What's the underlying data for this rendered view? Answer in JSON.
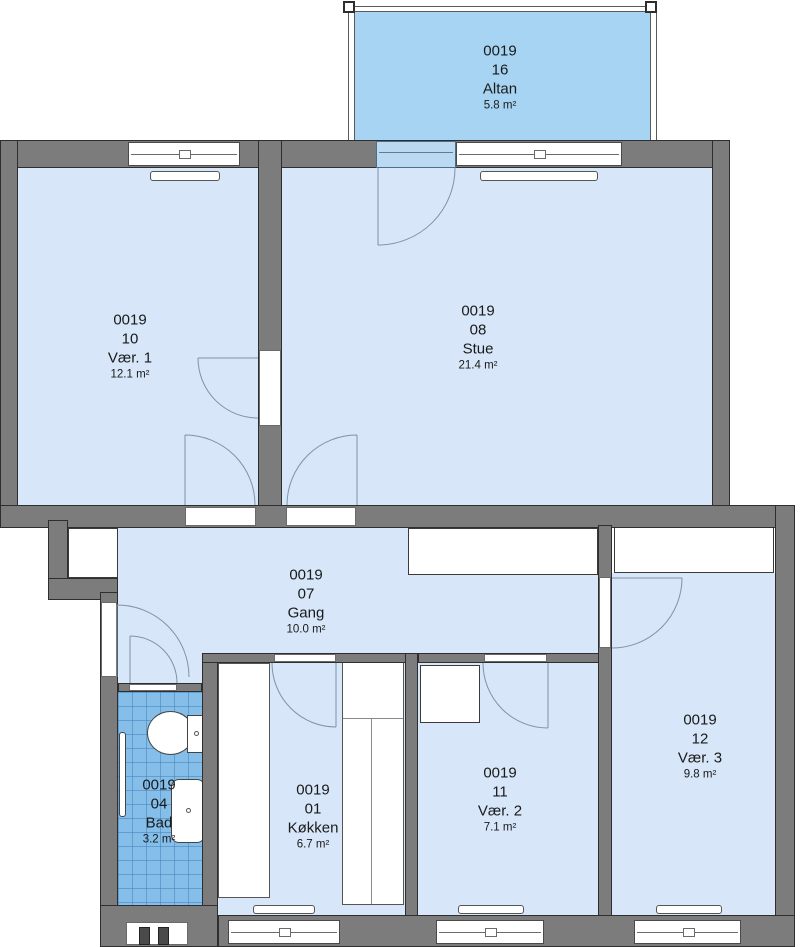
{
  "plan": {
    "unit_id": "0019",
    "colors": {
      "wall": "#7c7c7c",
      "room_fill": "#d7e6f8",
      "balcony_fill": "#a7d4f2",
      "bath_fill": "#84bee9",
      "arc": "#7e93a9"
    },
    "rooms": [
      {
        "id": "altan",
        "unit": "0019",
        "number": "16",
        "name": "Altan",
        "area": "5.8 m²"
      },
      {
        "id": "vaer1",
        "unit": "0019",
        "number": "10",
        "name": "Vær. 1",
        "area": "12.1 m²"
      },
      {
        "id": "stue",
        "unit": "0019",
        "number": "08",
        "name": "Stue",
        "area": "21.4 m²"
      },
      {
        "id": "gang",
        "unit": "0019",
        "number": "07",
        "name": "Gang",
        "area": "10.0 m²"
      },
      {
        "id": "bad",
        "unit": "0019",
        "number": "04",
        "name": "Bad",
        "area": "3.2 m²"
      },
      {
        "id": "koekken",
        "unit": "0019",
        "number": "01",
        "name": "Køkken",
        "area": "6.7 m²"
      },
      {
        "id": "vaer2",
        "unit": "0019",
        "number": "11",
        "name": "Vær. 2",
        "area": "7.1 m²"
      },
      {
        "id": "vaer3",
        "unit": "0019",
        "number": "12",
        "name": "Vær. 3",
        "area": "9.8 m²"
      }
    ]
  }
}
